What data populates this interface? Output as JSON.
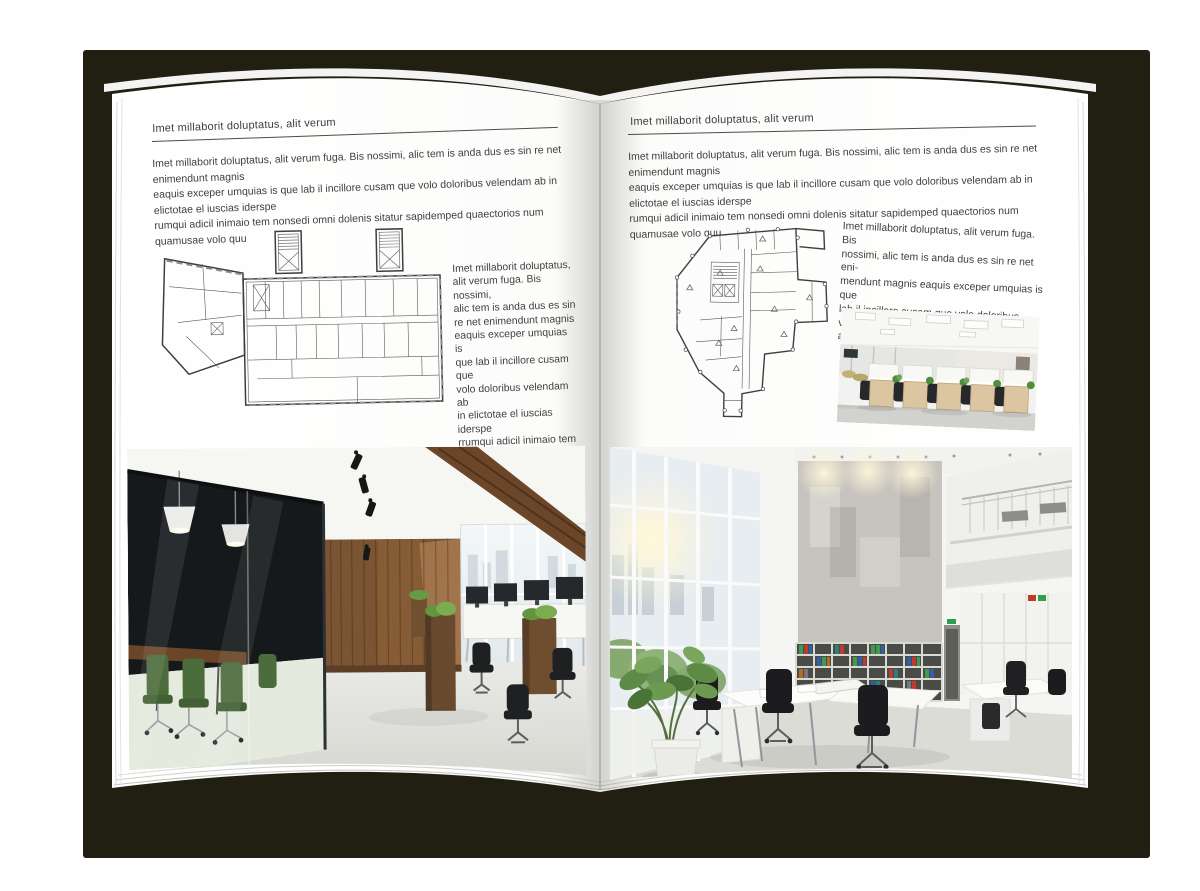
{
  "palette": {
    "backdrop": "#201f11",
    "paper": "#ffffff",
    "text": "#3f3f3f",
    "rule": "#4c4c4c"
  },
  "left_page": {
    "header": "Imet millaborit doluptatus, alit verum",
    "intro_lines": [
      "Imet millaborit doluptatus, alit verum fuga. Bis nossimi, alic tem is anda dus es sin re net enimendunt magnis",
      "eaquis exceper umquias is que lab il incillore cusam que volo doloribus velendam ab in elictotae el iuscias iderspe",
      "rumqui adicil inimaio tem nonsedi omni dolenis sitatur sapidemped quaectorios num quamusae volo quu"
    ],
    "side_lines": [
      "Imet millaborit doluptatus,",
      "alit verum fuga. Bis nossimi,",
      "alic tem is anda dus es sin",
      "re net enimendunt magnis",
      "eaquis exceper umquias is",
      "que lab il incillore cusam que",
      "volo doloribus velendam ab",
      "in elictotae el iuscias iderspe",
      "rrumqui adicil inimaio tem",
      "nonsedi omni dolenis sitatur",
      "sapidemped quaectorios num",
      "quamusae volo quu"
    ]
  },
  "right_page": {
    "header": "Imet millaborit doluptatus, alit verum",
    "intro_lines": [
      "Imet millaborit doluptatus, alit verum fuga. Bis nossimi, alic tem is anda dus es sin re net enimendunt magnis",
      "eaquis exceper umquias is que lab il incillore cusam que volo doloribus velendam ab in elictotae el iuscias iderspe",
      "rumqui adicil inimaio tem nonsedi omni dolenis sitatur sapidemped quaectorios num quamusae volo quu"
    ],
    "side_lines": [
      "Imet millaborit doluptatus, alit verum fuga. Bis",
      "nossimi, alic tem is anda dus es sin re net eni-",
      "mendunt magnis eaquis exceper umquias is que",
      "lab il incillore cusam que volo doloribus velendam",
      "ab in elictotae el iuscias iders"
    ]
  }
}
